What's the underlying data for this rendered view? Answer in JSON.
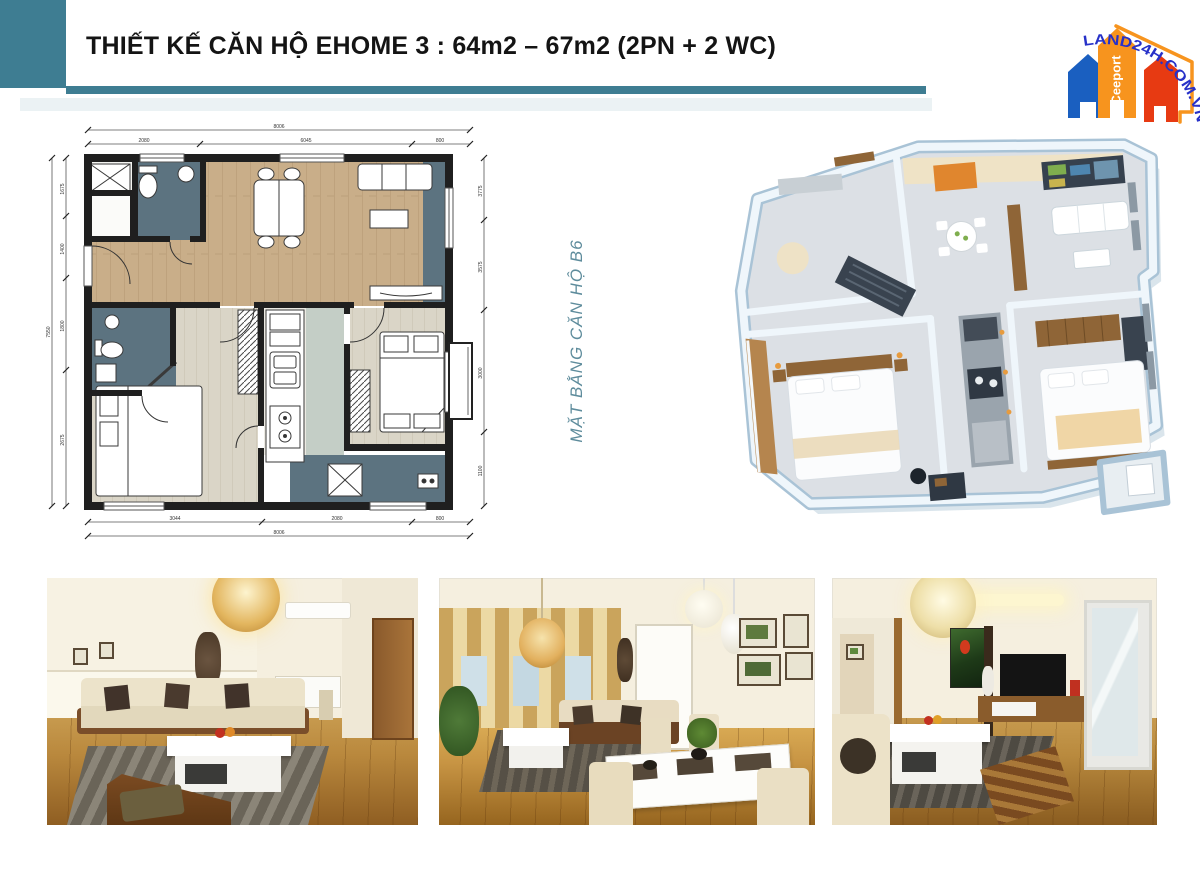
{
  "page": {
    "background": "#FFFFFF",
    "width_px": 1200,
    "height_px": 870
  },
  "header": {
    "title": "THIẾT KẾ CĂN HỘ EHOME 3 : 64m2 – 67m2 (2PN + 2 WC)",
    "accent_color": "#3E7D92"
  },
  "logo": {
    "arc_text": "LAND24H.COM.VN",
    "brand": "Ceeport",
    "colors": {
      "arc_text": "#2731C8",
      "house_blue": "#1A5FC0",
      "house_orange": "#F7941E",
      "house_red": "#E73A12"
    }
  },
  "plan_2d": {
    "label_vertical": "MẶT BẰNG CĂN HỘ B6",
    "label_color": "#5E8C9C",
    "colors": {
      "walls": "#1F1F1F",
      "living_dining_floor": "#C9AE89",
      "bedroom_floor": "#DAD5C7",
      "bathroom_balcony": "#5C7380",
      "corridor": "#C4CEC6"
    },
    "dims": {
      "top_overall": "8006",
      "top_segments": [
        "2080",
        "6045",
        "800"
      ],
      "left_overall": "7550",
      "left_segments": [
        "1675",
        "1400",
        "1800",
        "2675"
      ],
      "right_segments": [
        "3775",
        "3575",
        "3000",
        "1100"
      ],
      "bottom_segments": [
        "3044",
        "2080",
        "800"
      ],
      "bottom_overall": "8006"
    }
  },
  "plan_3d": {
    "colors": {
      "walls": "#EFF6FB",
      "wall_shadow": "#A9C3D6",
      "floor": "#DCE0E5",
      "wood": "#92683C",
      "dark_fittings": "#39434F",
      "accent_glow": "#E79B3E"
    }
  },
  "photos": {
    "count": 3,
    "items": [
      {
        "name": "living-room-sofa-view"
      },
      {
        "name": "living-dining-window-view"
      },
      {
        "name": "living-room-tv-view"
      }
    ],
    "palette": {
      "wall": "#F5EFDF",
      "wood_floor": "#B9883D",
      "sofa": "#EAE0C6",
      "rug": "#5A544A"
    }
  }
}
